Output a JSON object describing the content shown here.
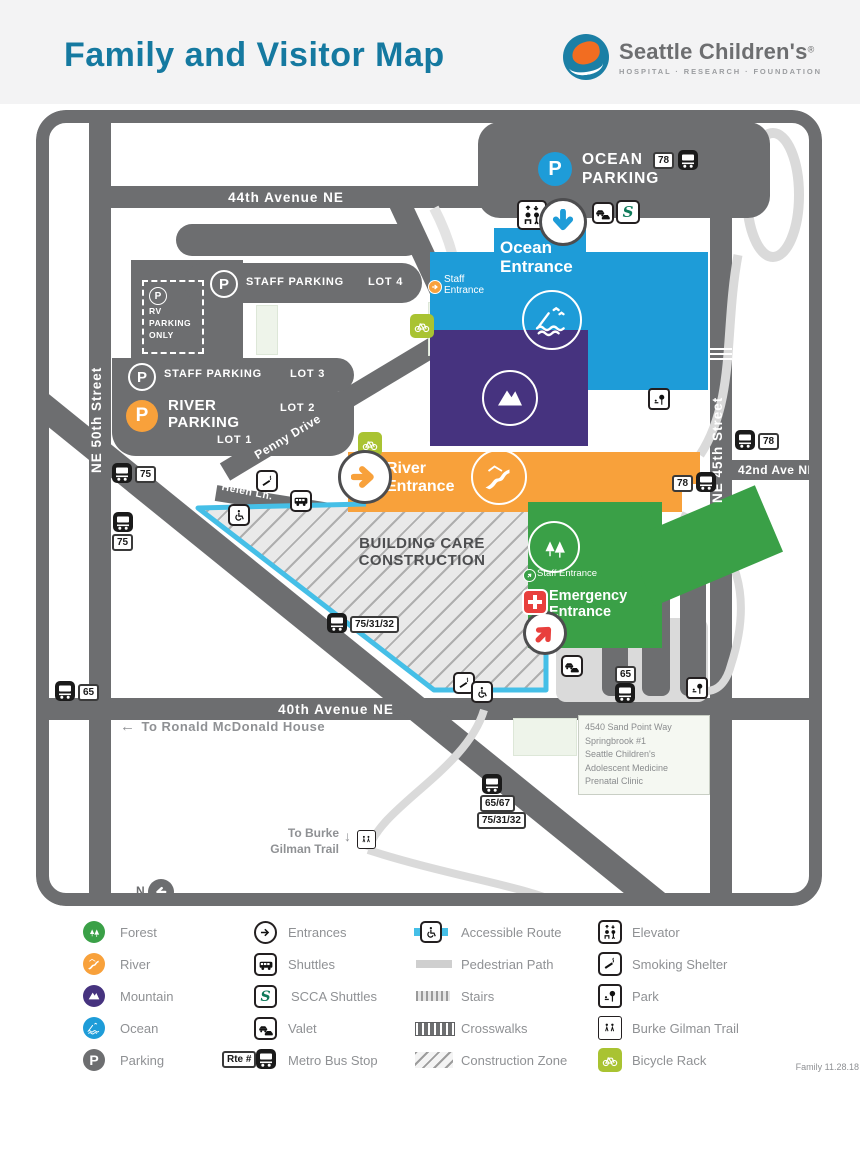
{
  "header": {
    "title": "Family and Visitor Map",
    "logo": {
      "name": "Seattle Children's",
      "registered": "®",
      "tagline": "HOSPITAL · RESEARCH · FOUNDATION"
    }
  },
  "colors": {
    "title_teal": "#1579A0",
    "road_gray": "#6D6E70",
    "ocean_blue": "#1E9CD8",
    "mountain_purple": "#46337F",
    "river_orange": "#F8A13B",
    "forest_green": "#3AA047",
    "accessible_cyan": "#45BFE7",
    "bike_green": "#A9C332",
    "emergency_red": "#E8403D"
  },
  "map": {
    "streets": {
      "ne_50th": "NE 50th Street",
      "ave_44th": "44th Avenue NE",
      "ne_45th": "NE 45th Street",
      "ave_42nd": "42nd Ave NE",
      "ave_40th": "40th Avenue NE",
      "sand_point": "Sand Point Way NE",
      "penny": "Penny Drive",
      "helen": "Helen Ln."
    },
    "parking": {
      "ocean": "OCEAN PARKING",
      "staff": "STAFF PARKING",
      "lot4": "LOT 4",
      "lot3": "LOT 3",
      "lot2": "LOT 2",
      "lot1": "LOT 1",
      "river": "RIVER PARKING",
      "rv": "RV PARKING ONLY",
      "p": "P"
    },
    "entrances": {
      "ocean": "Ocean Entrance",
      "river": "River Entrance",
      "emergency": "Emergency Entrance",
      "staff_ocean": "Staff Entrance",
      "staff_forest": "Staff Entrance"
    },
    "construction": "BUILDING CARE CONSTRUCTION",
    "bus_routes": [
      "78",
      "75",
      "75",
      "65",
      "75/31/32",
      "65/67",
      "75/31/32",
      "65",
      "78",
      "78"
    ],
    "notes": {
      "rmh_arrow": "←",
      "rmh": "To Ronald McDonald House",
      "burke_line1": "To Burke",
      "burke_line2": "Gilman Trail",
      "burke_arrow": "↓",
      "compass": "N"
    },
    "clinic": [
      "4540 Sand Point Way",
      "Springbrook #1",
      "Seattle Children's",
      "Adolescent Medicine",
      "Prenatal Clinic"
    ]
  },
  "legend": {
    "col1": [
      "Forest",
      "River",
      "Mountain",
      "Ocean",
      "Parking"
    ],
    "col2": [
      "Entrances",
      "Shuttles",
      "SCCA Shuttles",
      "Valet",
      "Metro Bus Stop"
    ],
    "col3": [
      "Accessible Route",
      "Pedestrian Path",
      "Stairs",
      "Crosswalks",
      "Construction Zone"
    ],
    "col4": [
      "Elevator",
      "Smoking Shelter",
      "Park",
      "Burke Gilman Trail",
      "Bicycle Rack"
    ],
    "rte_label": "Rte #",
    "version": "Family 11.28.18"
  }
}
